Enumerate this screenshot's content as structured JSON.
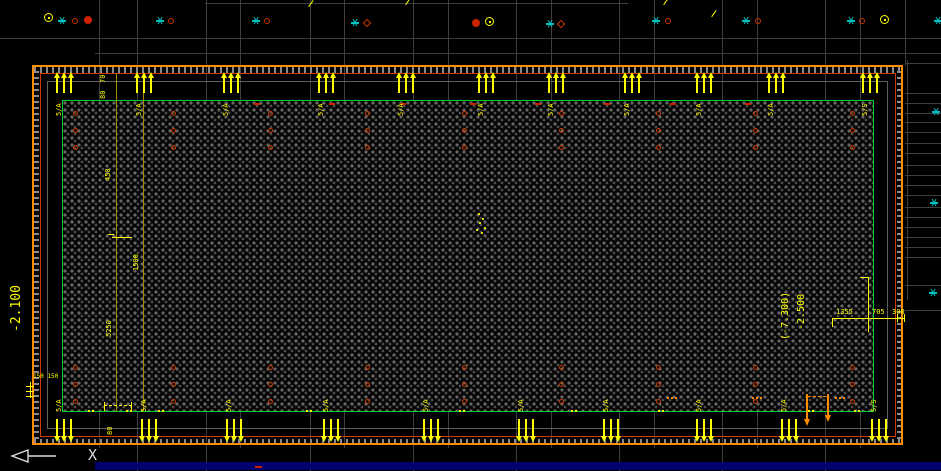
{
  "app": {
    "type": "cad-viewport-foundation-plan"
  },
  "colors": {
    "background": "#000000",
    "grid": "#3e3e3e",
    "outer_border": "#ff8c00",
    "inner_border": "#d43a00",
    "green_outline": "#00d432",
    "annotation_yellow": "#ffff00",
    "olive_dimline": "#a58e00",
    "pile_red": "#cf3a00",
    "cyan_marker": "#00c0c0",
    "blue_strip": "#00006e",
    "ucs_white": "#dddddd"
  },
  "ucs": {
    "axis_label": "X"
  },
  "dimensions": {
    "left_level": "-2.100",
    "right_level": "-2.500",
    "right_level_alt": "(-7.300)",
    "right_dims": [
      "1355",
      "705",
      "300"
    ],
    "column_dims": {
      "top_a": "70",
      "top_b": "80",
      "mid_a": "450",
      "mid_b": "5250",
      "mid_c": "1500",
      "bottom_a": "80",
      "pad": "150 150"
    }
  },
  "edge_markers": {
    "top": {
      "xs": [
        65,
        145,
        232,
        327,
        407,
        487,
        557,
        633,
        705,
        777,
        871
      ],
      "labels": [
        "5/A",
        "5/A",
        "5/A",
        "5/A",
        "5/A",
        "5/A",
        "5/A",
        "5/A",
        "5/A",
        "5/A",
        "5/S"
      ]
    },
    "bottom": {
      "xs": [
        65,
        150,
        235,
        332,
        432,
        527,
        612,
        705,
        790,
        880
      ],
      "labels": [
        "5/A",
        "5/A",
        "5/A",
        "5/A",
        "5/A",
        "5/A",
        "5/A",
        "5/A",
        "5/A",
        "5/S"
      ]
    }
  },
  "piles": {
    "columns_x": [
      75,
      173,
      270,
      367,
      464,
      561,
      658,
      755,
      852
    ],
    "top_rows_y": [
      113,
      130,
      147
    ],
    "bottom_rows_y": [
      367,
      384,
      401
    ]
  },
  "screen_markers": [
    {
      "type": "yellow-target",
      "x": 48,
      "y": 17
    },
    {
      "type": "cyan-star",
      "x": 62,
      "y": 21
    },
    {
      "type": "red-circle",
      "x": 75,
      "y": 21
    },
    {
      "type": "red-blob",
      "x": 88,
      "y": 20
    },
    {
      "type": "cyan-star",
      "x": 160,
      "y": 21
    },
    {
      "type": "red-circle",
      "x": 171,
      "y": 21
    },
    {
      "type": "cyan-star",
      "x": 256,
      "y": 21
    },
    {
      "type": "red-circle",
      "x": 267,
      "y": 21
    },
    {
      "type": "cyan-star",
      "x": 355,
      "y": 23
    },
    {
      "type": "red-diamond",
      "x": 367,
      "y": 23
    },
    {
      "type": "red-blob",
      "x": 476,
      "y": 23
    },
    {
      "type": "yellow-target",
      "x": 489,
      "y": 21
    },
    {
      "type": "cyan-star",
      "x": 550,
      "y": 24
    },
    {
      "type": "red-diamond",
      "x": 561,
      "y": 24
    },
    {
      "type": "cyan-star",
      "x": 656,
      "y": 21
    },
    {
      "type": "red-circle",
      "x": 668,
      "y": 21
    },
    {
      "type": "cyan-star",
      "x": 746,
      "y": 21
    },
    {
      "type": "red-circle",
      "x": 758,
      "y": 21
    },
    {
      "type": "cyan-star",
      "x": 851,
      "y": 21
    },
    {
      "type": "red-circle",
      "x": 862,
      "y": 21
    },
    {
      "type": "yellow-target",
      "x": 884,
      "y": 19
    },
    {
      "type": "cyan-star",
      "x": 938,
      "y": 21
    }
  ],
  "right_cyan_stars": [
    [
      936,
      112
    ],
    [
      934,
      203
    ],
    [
      933,
      293
    ]
  ],
  "yellow_slashes": [
    [
      307,
      3
    ],
    [
      404,
      1
    ],
    [
      662,
      1
    ],
    [
      710,
      13
    ]
  ],
  "ticks": {
    "top_red_xs": [
      257,
      332,
      403,
      473,
      538,
      607,
      673,
      748
    ],
    "bottom_yellow_xs": [
      92,
      130,
      162,
      310,
      463,
      575,
      662,
      812,
      858
    ],
    "bottom_orange_xs": [
      672,
      757,
      840
    ]
  },
  "geometry": {
    "olive_lines": [
      [
        116,
        73,
        339
      ],
      [
        143,
        85,
        327
      ]
    ],
    "grid_verticals_top_x": [
      99,
      137,
      206,
      240,
      310,
      344,
      413,
      448,
      516,
      551,
      619,
      654,
      722,
      757,
      825,
      860
    ],
    "grid_vertical_right_x": 905,
    "grid_verticals_band_bottom_x": [
      99,
      137,
      206,
      240,
      310,
      344,
      413,
      448,
      516,
      551,
      619,
      654,
      722,
      757,
      825,
      860
    ],
    "grid_verticals_below_x": [
      137,
      206,
      310,
      413,
      516,
      619,
      722,
      825
    ],
    "grid_horizontals": [
      [
        3,
        205,
        628
      ],
      [
        38,
        0,
        941
      ],
      [
        53,
        95,
        941
      ]
    ],
    "right_stack": {
      "x1": 905,
      "x2": 941,
      "ys": [
        63,
        93,
        103,
        113,
        122,
        132,
        143,
        153,
        165,
        175,
        185,
        195,
        207,
        217,
        227,
        237,
        247,
        257,
        285,
        310
      ]
    },
    "right_vertical": [
      907,
      60,
      240
    ],
    "yellow_lines": [
      [
        26,
        386,
        8,
        1
      ],
      [
        26,
        391,
        8,
        1
      ],
      [
        26,
        396,
        8,
        1
      ],
      [
        30,
        382,
        1,
        16
      ],
      [
        860,
        277,
        9,
        1
      ],
      [
        868,
        278,
        1,
        54
      ],
      [
        832,
        318,
        73,
        1
      ],
      [
        832,
        318,
        1,
        9
      ],
      [
        868,
        314,
        1,
        8
      ],
      [
        897,
        314,
        1,
        8
      ],
      [
        904,
        314,
        1,
        8
      ],
      [
        112,
        237,
        20,
        1
      ],
      [
        108,
        234,
        6,
        1
      ],
      [
        104,
        402,
        1,
        9
      ],
      [
        131,
        402,
        1,
        9
      ]
    ],
    "center_mark_dots": [
      [
        478,
        213
      ],
      [
        482,
        218
      ],
      [
        479,
        222
      ],
      [
        484,
        227
      ],
      [
        476,
        229
      ],
      [
        481,
        232
      ]
    ],
    "orange_arrows": [
      [
        806,
        394,
        32
      ],
      [
        827,
        394,
        28
      ]
    ]
  }
}
